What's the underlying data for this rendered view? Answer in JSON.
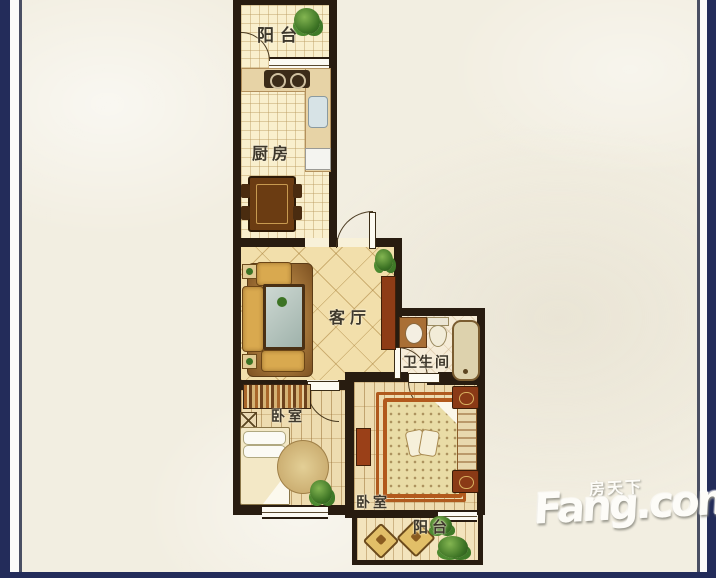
{
  "colors": {
    "frame_navy": "#232c5a",
    "frame_white": "#fbfbf9",
    "background_cream": "#f2eee1",
    "wall_dark_brown": "#281c10",
    "floor_cream": "#f9efcd",
    "accent_rust": "#b2591c",
    "plant_green": "#3c7324",
    "label_text": "#3d372b"
  },
  "rooms": [
    {
      "id": "balcony-top",
      "label": "阳台"
    },
    {
      "id": "kitchen",
      "label": "厨房"
    },
    {
      "id": "living-room",
      "label": "客厅"
    },
    {
      "id": "bathroom",
      "label": "卫生间"
    },
    {
      "id": "bedroom-left",
      "label": "卧室"
    },
    {
      "id": "bedroom-right",
      "label": "卧室"
    },
    {
      "id": "balcony-bottom",
      "label": "阳台"
    }
  ],
  "watermark": {
    "chinese": "房天下",
    "brand": "Fang.com"
  }
}
